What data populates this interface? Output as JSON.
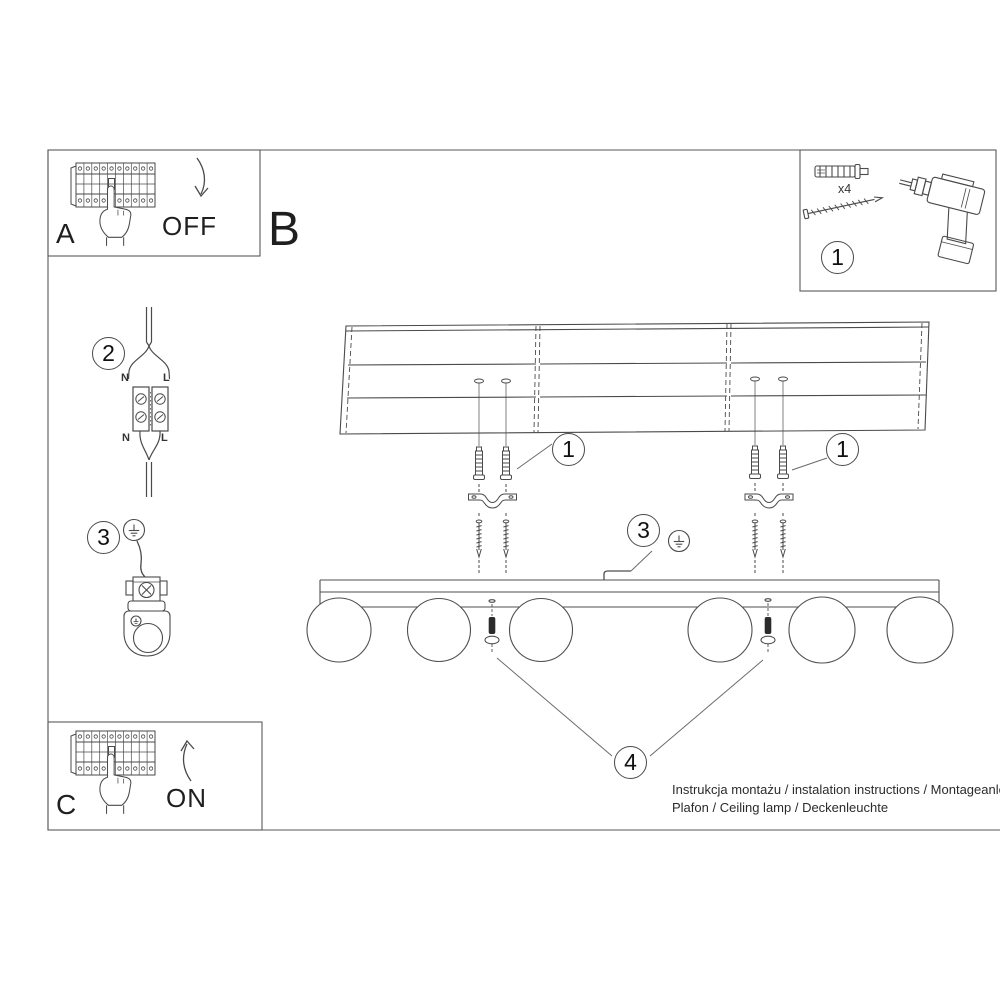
{
  "document": {
    "footer_line1": "Instrukcja montażu / instalation instructions / Montageanleitu",
    "footer_line2": "Plafon / Ceiling lamp / Deckenleuchte"
  },
  "sections": {
    "panel_a": {
      "label": "A",
      "switch_state": "OFF"
    },
    "panel_b": {
      "label": "B"
    },
    "panel_c": {
      "label": "C",
      "switch_state": "ON"
    },
    "parts": {
      "callout": "1",
      "quantity": "x4"
    },
    "wiring": {
      "callout": "2",
      "terminal_top_left": "N",
      "terminal_top_right": "L",
      "terminal_bottom_left": "N",
      "terminal_bottom_right": "L"
    },
    "grounding": {
      "callout": "3"
    }
  },
  "callouts": {
    "anchors_left": "1",
    "anchors_right": "1",
    "ground_wire": "3",
    "set_screws": "4"
  }
}
